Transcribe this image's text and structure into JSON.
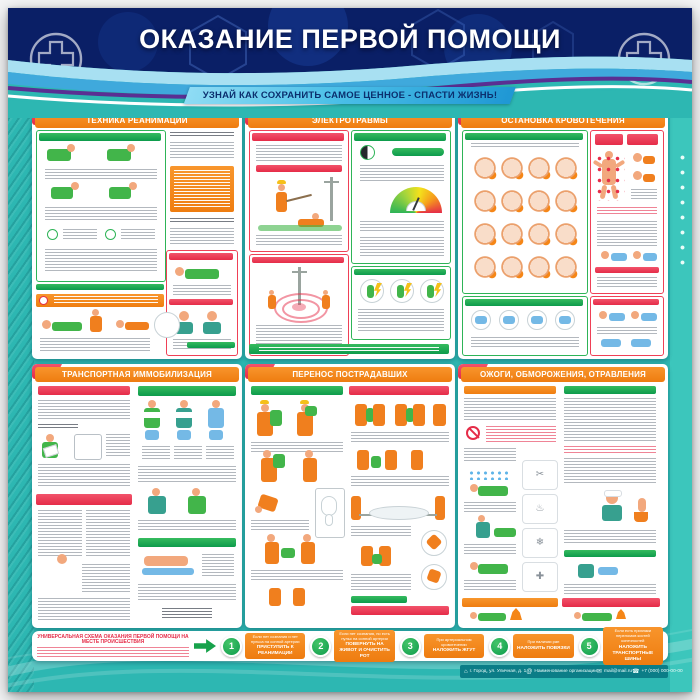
{
  "header": {
    "title": "ОКАЗАНИЕ ПЕРВОЙ ПОМОЩИ"
  },
  "banner": {
    "text": "УЗНАЙ КАК СОХРАНИТЬ САМОЕ ЦЕННОЕ - СПАСТИ ЖИЗНЬ!"
  },
  "panels": [
    {
      "number": "1",
      "title": "ТЕХНИКА РЕАНИМАЦИИ"
    },
    {
      "number": "2",
      "title": "ЭЛЕКТРОТРАВМЫ"
    },
    {
      "number": "3",
      "title": "ОСТАНОВКА КРОВОТЕЧЕНИЯ"
    },
    {
      "number": "4",
      "title": "ТРАНСПОРТНАЯ ИММОБИЛИЗАЦИЯ"
    },
    {
      "number": "5",
      "title": "ПЕРЕНОС ПОСТРАДАВШИХ"
    },
    {
      "number": "6",
      "title": "ОЖОГИ, ОБМОРОЖЕНИЯ, ОТРАВЛЕНИЯ"
    }
  ],
  "scheme": {
    "title": "УНИВЕРСАЛЬНАЯ СХЕМА ОКАЗАНИЯ ПЕРВОЙ ПОМОЩИ НА МЕСТЕ ПРОИСШЕСТВИЯ",
    "steps": [
      {
        "number": "1",
        "condition": "Если нет сознания и нет пульса на сонной артерии",
        "action": "ПРИСТУПИТЬ К РЕАНИМАЦИИ"
      },
      {
        "number": "2",
        "condition": "Если нет сознания, но есть пульс на сонной артерии",
        "action": "ПОВЕРНУТЬ НА ЖИВОТ И ОЧИСТИТЬ РОТ"
      },
      {
        "number": "3",
        "condition": "При артериальном кровотечении",
        "action": "НАЛОЖИТЬ ЖГУТ"
      },
      {
        "number": "4",
        "condition": "При наличии ран",
        "action": "НАЛОЖИТЬ ПОВЯЗКИ"
      },
      {
        "number": "5",
        "condition": "Если есть признаки переломов костей конечностей",
        "action": "НАЛОЖИТЬ ТРАНСПОРТНЫЕ ШИНЫ"
      }
    ]
  },
  "footer": {
    "items": [
      {
        "icon": "address-icon",
        "glyph": "⌂",
        "text": "г. Город, ул. Уличная, д. 1"
      },
      {
        "icon": "organization-icon",
        "glyph": "@",
        "text": "Наименование организации"
      },
      {
        "icon": "email-icon",
        "glyph": "✉",
        "text": "mail@mail.ru"
      },
      {
        "icon": "phone-icon",
        "glyph": "☎",
        "text": "+7 (000) 000-00-00"
      }
    ]
  },
  "colors": {
    "teal_bg": "#2db7b2",
    "navy_header": "#0a1f66",
    "panel_orange": "#f28а1c",
    "tab_red": "#e32b47",
    "accent_green": "#0d9b4c",
    "banner_blue": "#4cc0e8"
  }
}
